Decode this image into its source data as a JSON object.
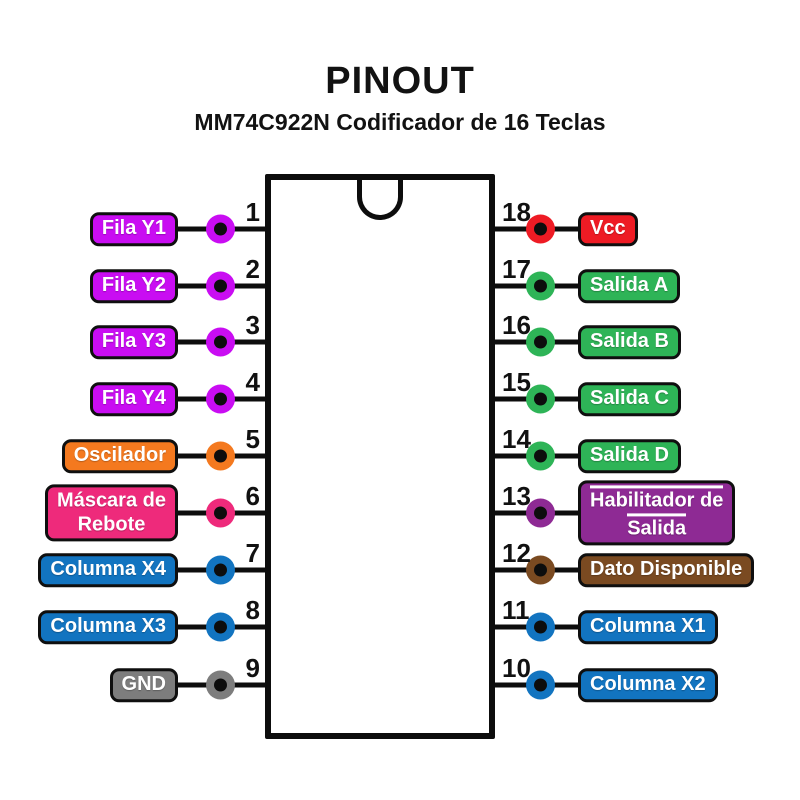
{
  "header": {
    "title": "PINOUT",
    "subtitle": "MM74C922N Codificador de 16 Teclas"
  },
  "pins": {
    "left": [
      {
        "number": "1",
        "lines": [
          "Fila Y1"
        ],
        "color": "#c90df2"
      },
      {
        "number": "2",
        "lines": [
          "Fila Y2"
        ],
        "color": "#c90df2"
      },
      {
        "number": "3",
        "lines": [
          "Fila Y3"
        ],
        "color": "#c90df2"
      },
      {
        "number": "4",
        "lines": [
          "Fila Y4"
        ],
        "color": "#c90df2"
      },
      {
        "number": "5",
        "lines": [
          "Oscilador"
        ],
        "color": "#f4791f"
      },
      {
        "number": "6",
        "lines": [
          "Máscara de",
          "Rebote"
        ],
        "color": "#ee2a7b"
      },
      {
        "number": "7",
        "lines": [
          "Columna X4"
        ],
        "color": "#1274c0"
      },
      {
        "number": "8",
        "lines": [
          "Columna X3"
        ],
        "color": "#1274c0"
      },
      {
        "number": "9",
        "lines": [
          "GND"
        ],
        "color": "#7d7d7d"
      }
    ],
    "right": [
      {
        "number": "18",
        "lines": [
          "Vcc"
        ],
        "color": "#ee1b24"
      },
      {
        "number": "17",
        "lines": [
          "Salida A"
        ],
        "color": "#2eb457"
      },
      {
        "number": "16",
        "lines": [
          "Salida B"
        ],
        "color": "#2eb457"
      },
      {
        "number": "15",
        "lines": [
          "Salida C"
        ],
        "color": "#2eb457"
      },
      {
        "number": "14",
        "lines": [
          "Salida D"
        ],
        "color": "#2eb457"
      },
      {
        "number": "13",
        "lines": [
          "Habilitador de",
          "Salida"
        ],
        "color": "#8e2a94",
        "active_low": true
      },
      {
        "number": "12",
        "lines": [
          "Dato Disponible"
        ],
        "color": "#7a4a21"
      },
      {
        "number": "11",
        "lines": [
          "Columna X1"
        ],
        "color": "#1274c0"
      },
      {
        "number": "10",
        "lines": [
          "Columna X2"
        ],
        "color": "#1274c0"
      }
    ]
  }
}
